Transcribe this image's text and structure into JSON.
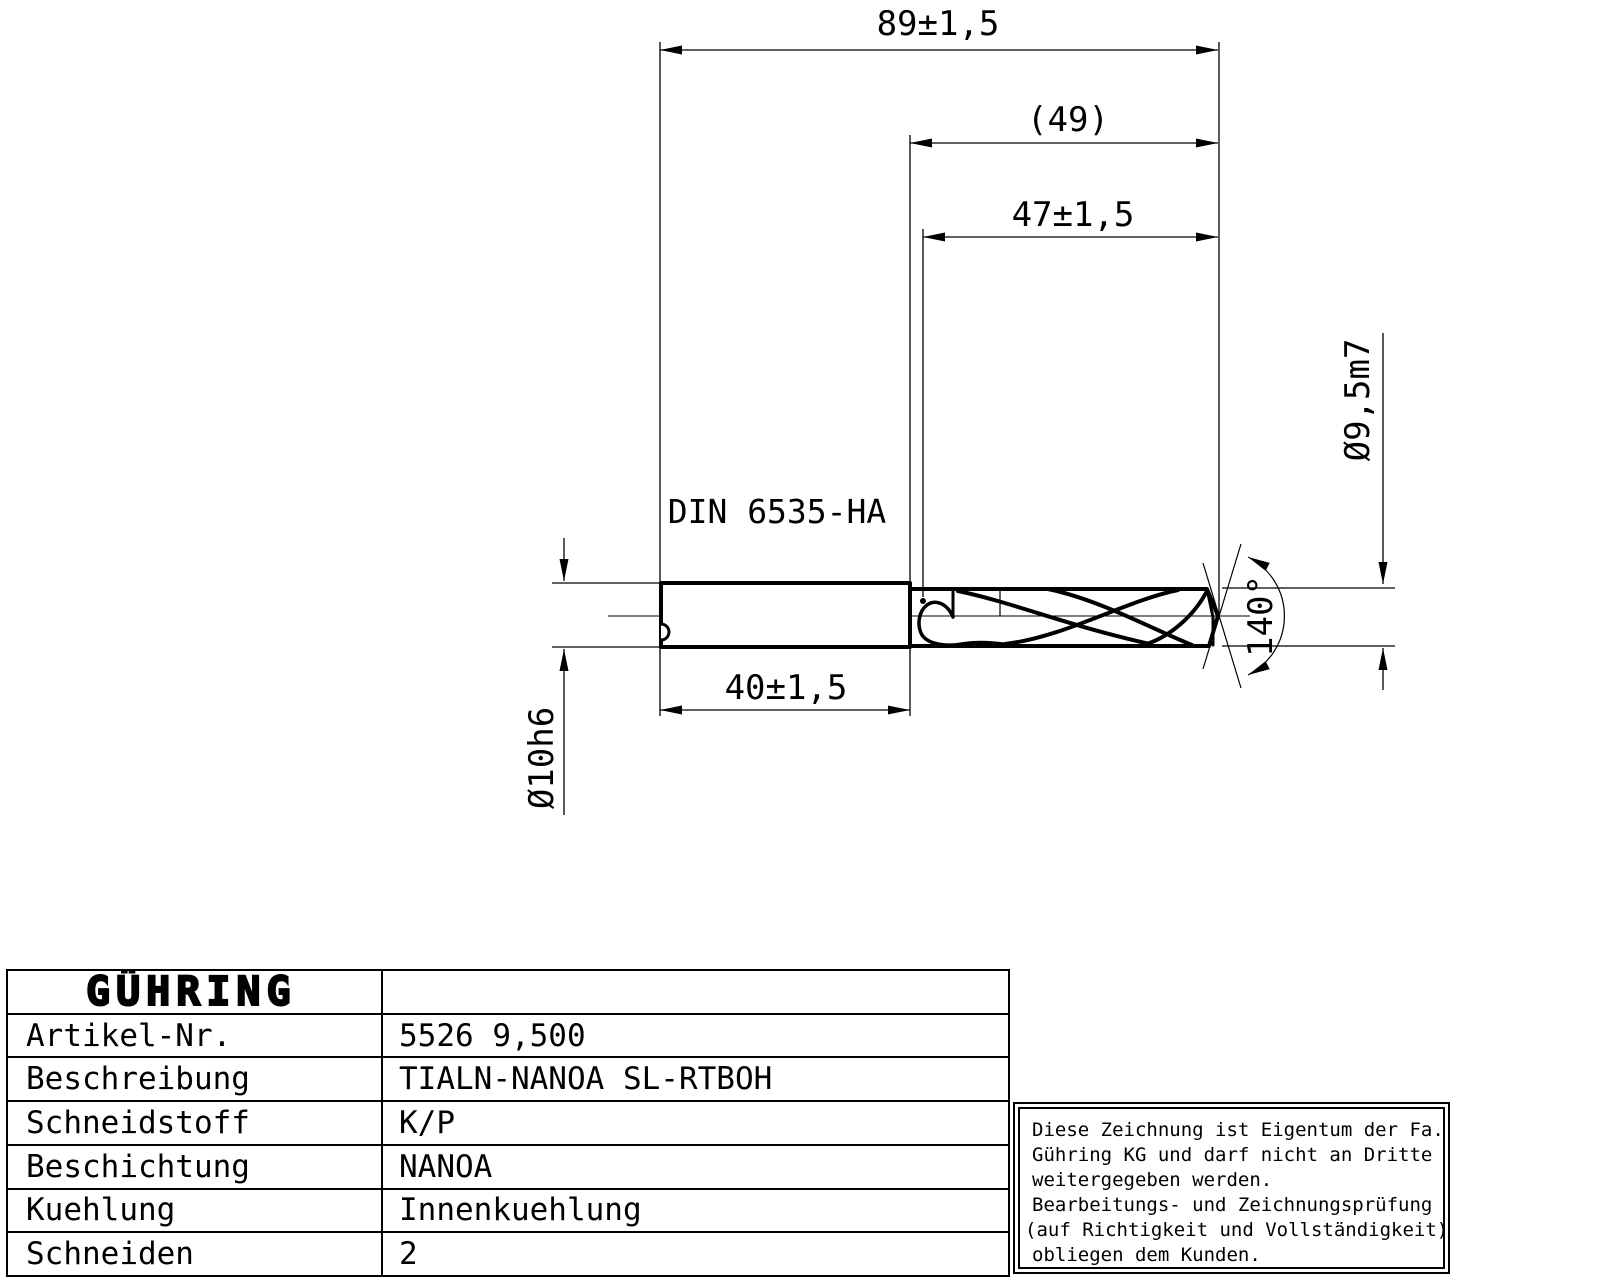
{
  "drawing": {
    "dim_overall_length": "89±1,5",
    "dim_ref_length": "(49)",
    "dim_flute_length": "47±1,5",
    "dim_shank_length": "40±1,5",
    "shank_standard": "DIN 6535-HA",
    "shank_diameter": "Ø10h6",
    "cutting_diameter": "Ø9,5m7",
    "point_angle": "140°"
  },
  "titleblock": {
    "brand": "GÜHRING",
    "rows": [
      {
        "label": "Artikel-Nr.",
        "value": "5526 9,500"
      },
      {
        "label": "Beschreibung",
        "value": "TIALN-NANOA SL-RTBOH"
      },
      {
        "label": "Schneidstoff",
        "value": "K/P"
      },
      {
        "label": "Beschichtung",
        "value": "NANOA"
      },
      {
        "label": "Kuehlung",
        "value": "Innenkuehlung"
      },
      {
        "label": "Schneiden",
        "value": "2"
      }
    ]
  },
  "disclaimer": {
    "lines": [
      "Diese Zeichnung ist Eigentum der Fa.",
      "Gühring KG und darf nicht an Dritte",
      "weitergegeben werden.",
      "Bearbeitungs- und Zeichnungsprüfung",
      "(auf Richtigkeit und Vollständigkeit)",
      "obliegen dem Kunden."
    ]
  },
  "colors": {
    "ink": "#000000",
    "paper": "#ffffff"
  }
}
